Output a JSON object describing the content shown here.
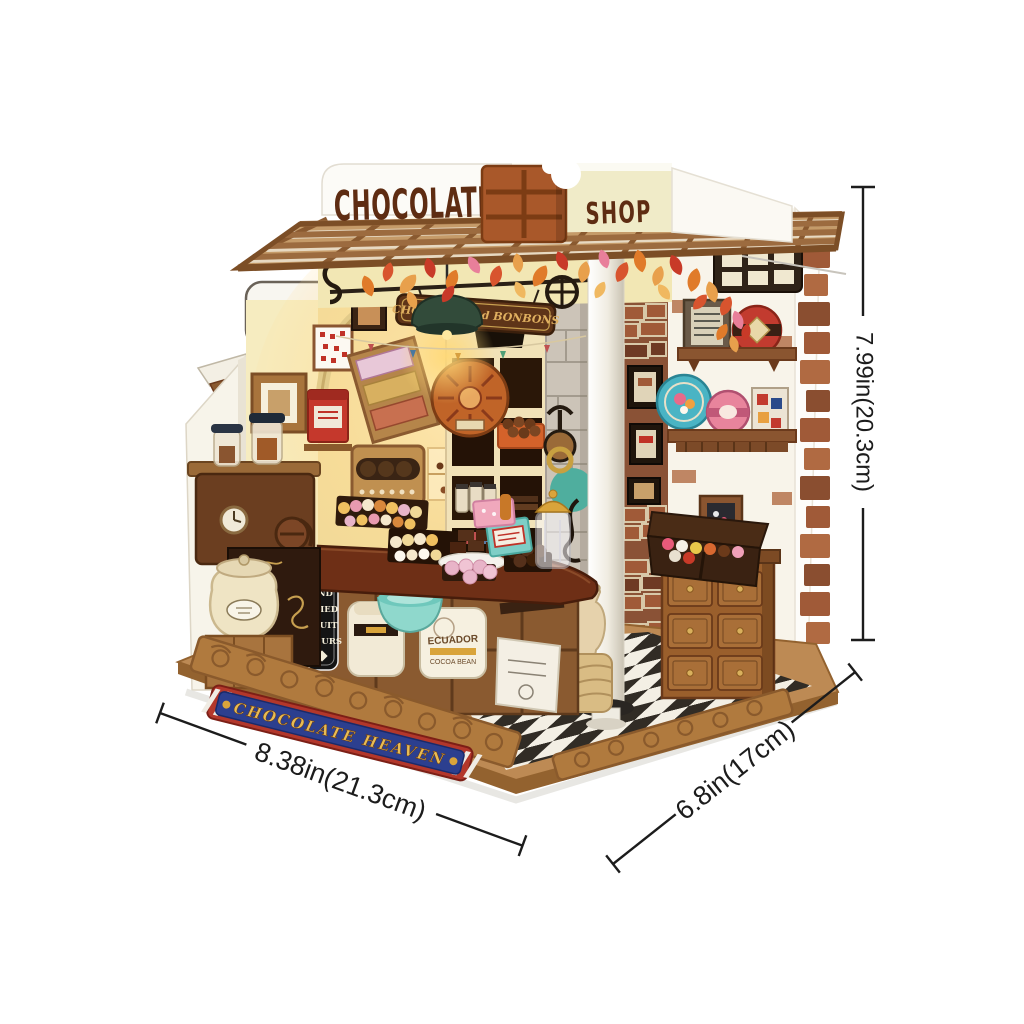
{
  "image_type": "Product photo of a DIY miniature dollhouse kit (chocolate shop) with printed dimension annotations",
  "storefront": {
    "sign_left": "CHOCOLATE",
    "sign_right": "SHOP",
    "hanging_sign": "CHOCOLAT and BONBONS",
    "base_banner": "CHOCOLATE HEAVEN",
    "menu_board_lines": [
      "FRUIT",
      "AND",
      "DRIED",
      "FRUIT",
      "FLOURS"
    ],
    "cocoa_sack_lines": [
      "ECUADOR",
      "COCOA BEAN"
    ]
  },
  "dimensions": {
    "height": "7.99in(20.3cm)",
    "width": "8.38in(21.3cm)",
    "depth": "6.8in(17cm)"
  },
  "colors": {
    "background": "#ffffff",
    "dimension_line": "#1c1c1c",
    "canopy_wood": "#c59b69",
    "sign_letters": "#5e2c12",
    "chocolate_bar": "#a9582a",
    "fascia": "#f2e7b4",
    "interior_wall": "#f0d997",
    "lamp_green": "#324b3a",
    "banner_blue": "#2c3f8f",
    "banner_red": "#b3372b",
    "banner_gold": "#e8bc54",
    "base_wood": "#b07a3e",
    "dresser_wood": "#9a5f2c",
    "floor_dark": "#15120e",
    "floor_light": "#f2efe8"
  }
}
